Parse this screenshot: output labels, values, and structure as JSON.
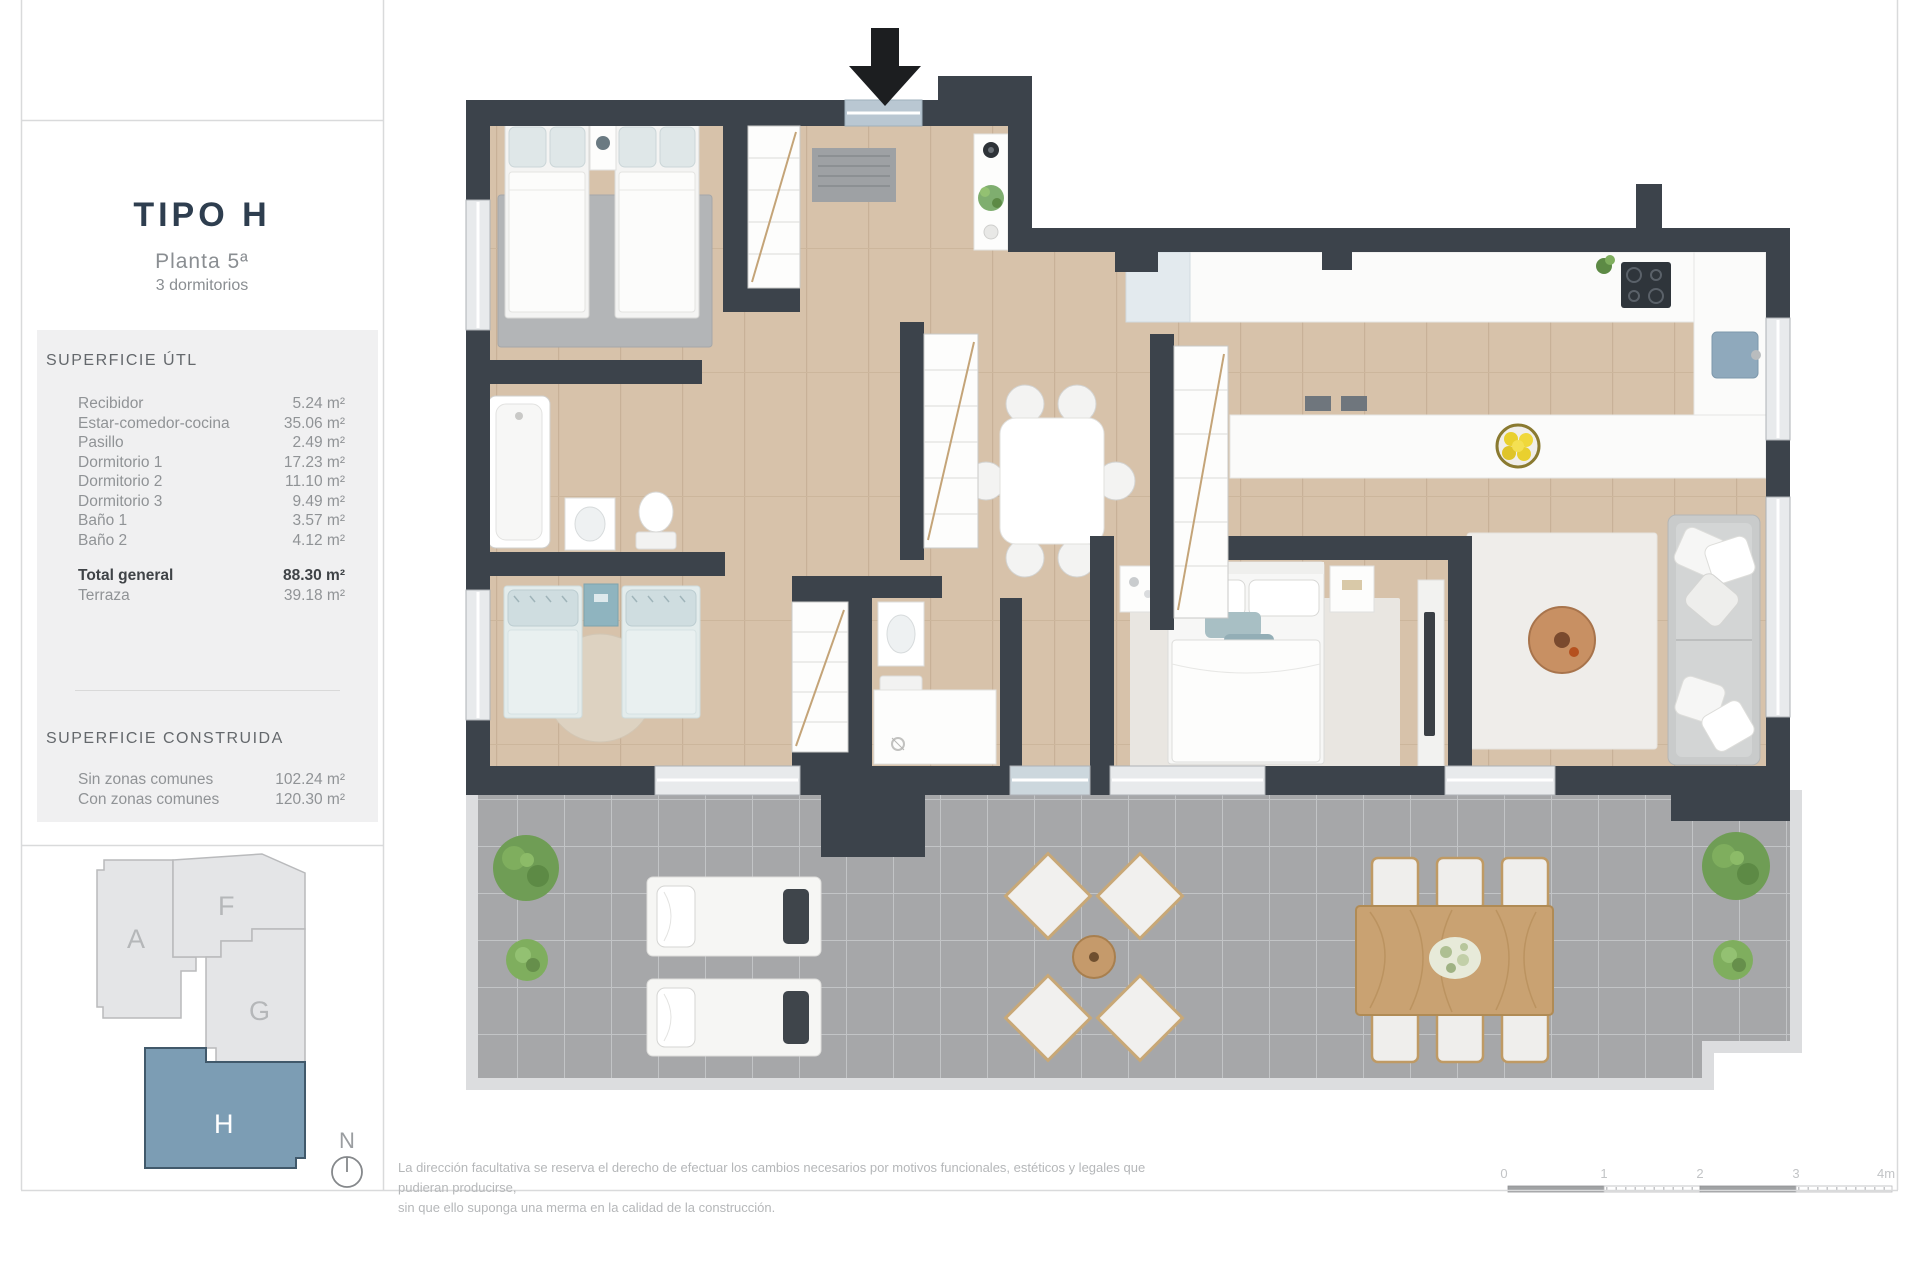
{
  "sidebar": {
    "title": "TIPO H",
    "subtitle": "Planta 5ª",
    "subtitle2": "3 dormitorios",
    "superficie_util": {
      "heading": "SUPERFICIE ÚTL",
      "rows": [
        {
          "label": "Recibidor",
          "value": "5.24 m²"
        },
        {
          "label": "Estar-comedor-cocina",
          "value": "35.06 m²"
        },
        {
          "label": "Pasillo",
          "value": "2.49 m²"
        },
        {
          "label": "Dormitorio 1",
          "value": "17.23 m²"
        },
        {
          "label": "Dormitorio 2",
          "value": "11.10 m²"
        },
        {
          "label": "Dormitorio 3",
          "value": "9.49 m²"
        },
        {
          "label": "Baño 1",
          "value": "3.57 m²"
        },
        {
          "label": "Baño 2",
          "value": "4.12 m²"
        }
      ],
      "total": {
        "label": "Total general",
        "value": "88.30 m²"
      },
      "terraza": {
        "label": "Terraza",
        "value": "39.18 m²"
      }
    },
    "superficie_construida": {
      "heading": "SUPERFICIE CONSTRUIDA",
      "rows": [
        {
          "label": "Sin zonas comunes",
          "value": "102.24 m²"
        },
        {
          "label": "Con zonas comunes",
          "value": "120.30 m²"
        }
      ]
    },
    "keyplan": {
      "buildings": [
        "A",
        "F",
        "G",
        "H"
      ],
      "highlighted": "H",
      "highlight_color": "#7c9db4",
      "building_color": "#e4e5e7"
    },
    "north_label": "N"
  },
  "footer": {
    "disclaimer_line1": "La dirección facultativa se reserva el derecho de efectuar los cambios necesarios por motivos funcionales, estéticos y legales que pudieran producirse,",
    "disclaimer_line2": "sin que ello suponga una merma en la calidad de la construcción.",
    "scale": {
      "ticks": [
        "0",
        "1",
        "2",
        "3",
        "4m"
      ]
    }
  },
  "floorplan": {
    "icons": {
      "entrance": "entrance-arrow-icon",
      "north": "north-compass-icon"
    },
    "colors": {
      "wall": "#3c434b",
      "wood_floor": "#d7c2aa",
      "terrace_tile": "#a6a7a9",
      "accent_blue": "#8fa9bc"
    }
  }
}
